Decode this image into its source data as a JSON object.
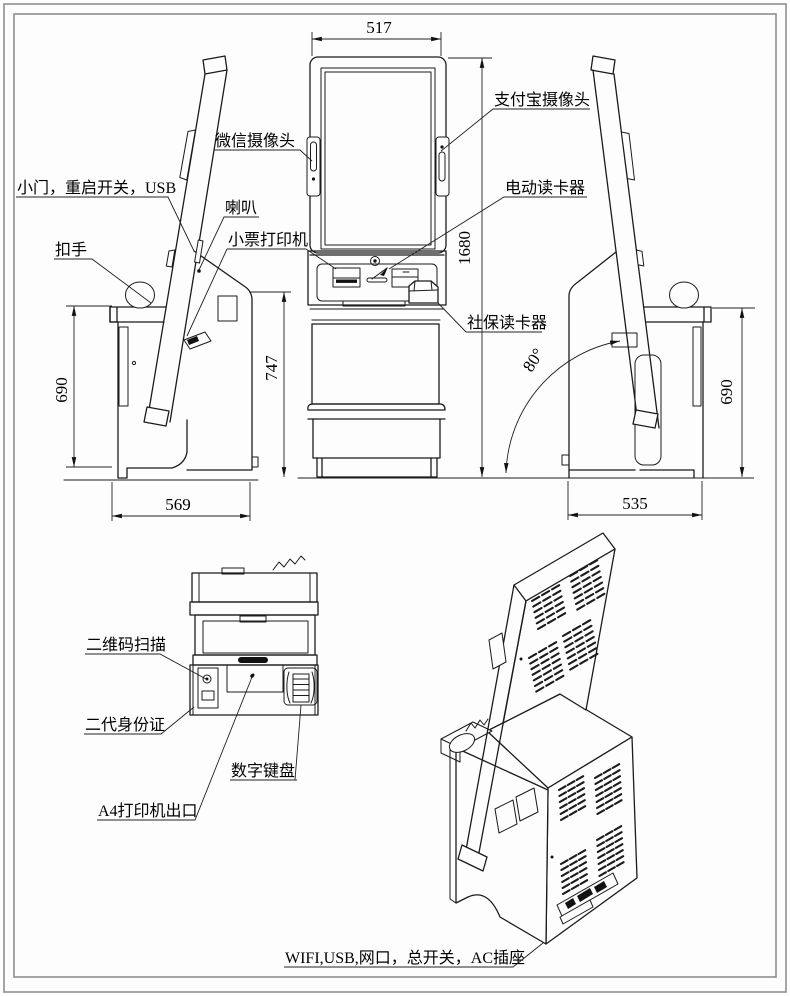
{
  "drawing": {
    "type": "kiosk-terminal-engineering-drawing",
    "views": [
      "left-side-view",
      "front-view",
      "right-side-view",
      "top-detail-view",
      "isometric-rear-view"
    ]
  },
  "callouts": {
    "door_usb": "小门，重启开关，USB",
    "handle": "扣手",
    "speaker": "喇叭",
    "receipt_printer": "小票打印机",
    "wechat_camera": "微信摄像头",
    "alipay_camera": "支付宝摄像头",
    "motor_card_reader": "电动读卡器",
    "social_card_reader": "社保读卡器",
    "qr_scanner": "二维码扫描",
    "id_card_reader": "二代身份证",
    "numeric_keypad": "数字键盘",
    "a4_printer_outlet": "A4打印机出口",
    "rear_ports": "WIFI,USB,网口，总开关，AC插座"
  },
  "dimensions": {
    "screen_width": "517",
    "total_height": "1680",
    "console_height_left": "690",
    "body_height": "747",
    "console_height_right": "690",
    "base_depth_left": "569",
    "base_depth_right": "535",
    "screen_angle": "80°"
  }
}
